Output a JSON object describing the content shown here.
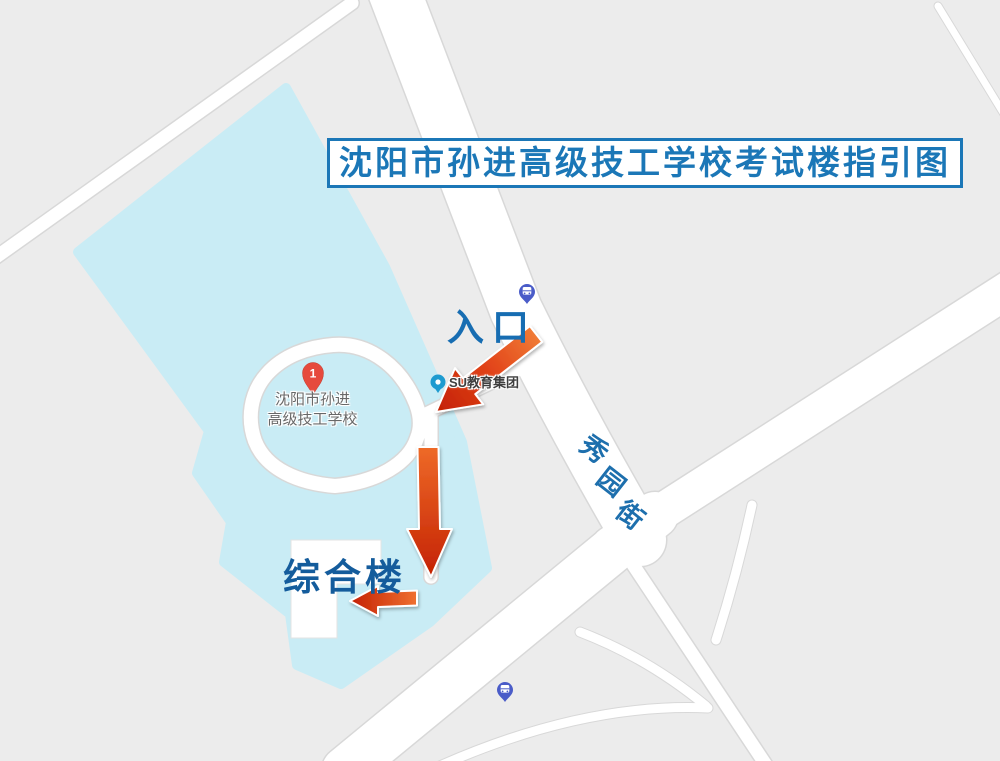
{
  "title": "沈阳市孙进高级技工学校考试楼指引图",
  "annotations": {
    "entrance": "入口",
    "building": "综合楼"
  },
  "school_marker": {
    "number": "1",
    "name_line1": "沈阳市孙进",
    "name_line2": "高级技工学校"
  },
  "poi": {
    "name": "SU教育集团"
  },
  "street": {
    "name": "秀园街",
    "chars": [
      "秀",
      "园",
      "街"
    ]
  },
  "colors": {
    "background": "#ececec",
    "campus_fill": "#c9ecf5",
    "road_fill": "#ffffff",
    "road_casing": "#d8d8d8",
    "title_blue": "#1b77b7",
    "label_blue": "#176db2",
    "arrow_red": "#c42103",
    "arrow_orange": "#ef7030",
    "pin_red": "#e64a3d",
    "poi_teal": "#1e9bd0",
    "bus_blue": "#4a5cc8",
    "school_text_gray": "#686868"
  }
}
